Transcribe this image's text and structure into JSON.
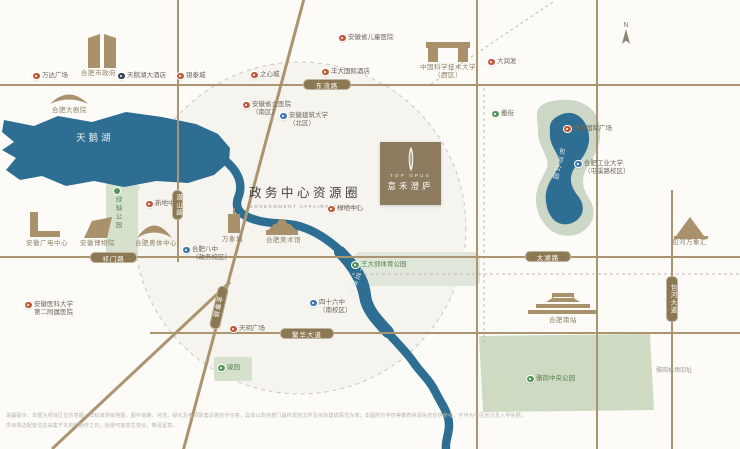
{
  "map": {
    "title_zh": "政务中心资源圈",
    "title_en": "GOVERNMENT AFFAIRS CENTER",
    "compass": "N"
  },
  "project_logo": {
    "name_en": "TOP OPUS",
    "name_zh": "意禾澄庐"
  },
  "water": {
    "lake": "天鹅湖",
    "river": "十五里河",
    "baohe_park": "包河公园"
  },
  "road_pills": {
    "dongliu": "东流路",
    "qimen": "祁门路",
    "taihu": "太湖路",
    "fanhua": "繁华大道",
    "qianshan": "潜山路",
    "baohe": "包河大道",
    "jinzhai": "金寨路"
  },
  "parks": {
    "lvzhou": "绿轴公园",
    "luogang_note": "骆岗机场旧址"
  },
  "buildings": [
    "合肥市政府",
    "合肥大剧院",
    "安徽广电中心",
    "安徽博物院",
    "合肥奥体中心",
    "万象城",
    "合肥美术馆",
    "中国科学技术大学\n（西区）",
    "合肥南站",
    "包河万象汇"
  ],
  "pois": [
    {
      "label": "万达广场",
      "type": "retail"
    },
    {
      "label": "天鹅湖大酒店",
      "type": "hotel"
    },
    {
      "label": "银泰城",
      "type": "retail"
    },
    {
      "label": "之心城",
      "type": "retail"
    },
    {
      "label": "丰大国际酒店",
      "type": "hotel"
    },
    {
      "label": "安徽省儿童医院",
      "type": "medical"
    },
    {
      "label": "大润发",
      "type": "retail"
    },
    {
      "label": "罍街",
      "type": "food"
    },
    {
      "label": "加侨国际广场",
      "type": "retail"
    },
    {
      "label": "合肥工业大学\n（屯溪路校区）",
      "type": "education"
    },
    {
      "label": "安徽省立医院\n（南区）",
      "type": "medical"
    },
    {
      "label": "安徽建筑大学\n（北区）",
      "type": "education"
    },
    {
      "label": "新地中心",
      "type": "retail"
    },
    {
      "label": "合肥八中\n（政务校区）",
      "type": "education"
    },
    {
      "label": "绿地中心",
      "type": "retail"
    },
    {
      "label": "王大郢体育公园",
      "type": "park"
    },
    {
      "label": "天玥广场",
      "type": "retail"
    },
    {
      "label": "四十六中\n（南校区）",
      "type": "education"
    },
    {
      "label": "骏园",
      "type": "park"
    },
    {
      "label": "骆岗中央公园",
      "type": "park"
    },
    {
      "label": "安徽医科大学\n第二附属医院",
      "type": "medical"
    }
  ],
  "disclaimer": {
    "line1": "温馨提示：本图为项目区位示意图，非标准测绘地图，图中道路、河流、绿化及各项配套设施仅作示意，具体以政府部门最终规划文件及实际建成情况为准；本图所示学校等教育资源信息仅供参考，不作为学区划分及入学依据。",
    "line2": "项目周边配套信息采集于本资料制作之日，后期可能发生变化，敬请留意。"
  }
}
